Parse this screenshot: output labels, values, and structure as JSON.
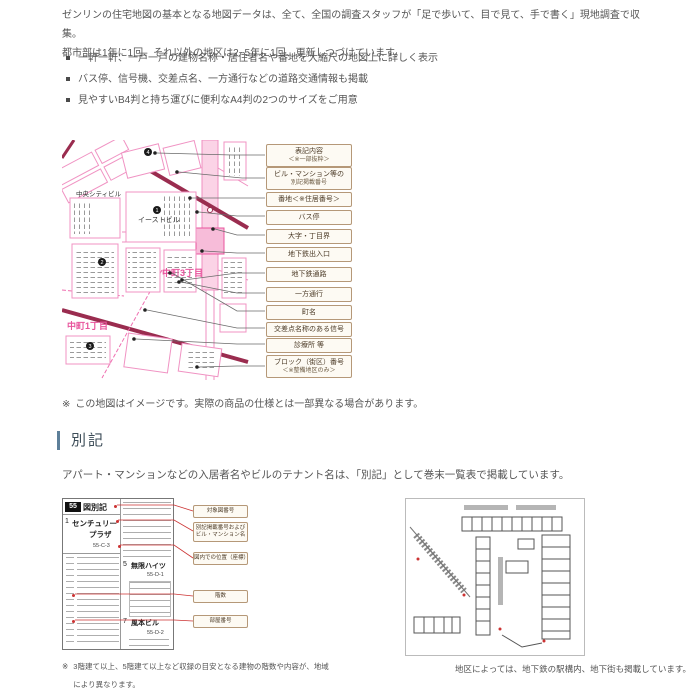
{
  "intro": {
    "line1": "ゼンリンの住宅地図の基本となる地図データは、全て、全国の調査スタッフが「足で歩いて、目で見て、手で書く」現地調査で収集。",
    "line2": "都市部は1年に1回、それ以外の地区は2~5年に1回、更新しつづけています。"
  },
  "features": {
    "item1": "一軒一軒、一戸一戸の建物名称・居住者名や番地を大縮尺の地図上に詳しく表示",
    "item2": "バス停、信号機、交差点名、一方通行などの道路交通情報も掲載",
    "item3": "見やすいB4判と持ち運びに便利なA4判の2つのサイズをご用意"
  },
  "map_figure": {
    "labels": {
      "building_a": "中央シティビル",
      "building_b": "イーストビル",
      "district_a": "中町3丁目",
      "district_b": "中町1丁目",
      "badge_1": "1",
      "badge_2": "2",
      "badge_3": "3",
      "badge_4": "4"
    },
    "callouts": [
      {
        "l1": "表記内容",
        "l2": "＜※一部抜粋＞"
      },
      {
        "l1": "ビル・マンション等の",
        "l2": "別記掲載番号"
      },
      {
        "l1": "番地＜※住居番号＞"
      },
      {
        "l1": "バス停"
      },
      {
        "l1": "大字・丁目界"
      },
      {
        "l1": "地下鉄出入口"
      },
      {
        "l1": "地下鉄通路"
      },
      {
        "l1": "一方通行"
      },
      {
        "l1": "町名"
      },
      {
        "l1": "交差点名称のある信号"
      },
      {
        "l1": "診療所 等"
      },
      {
        "l1": "ブロック（街区）番号",
        "l2": "＜※整備地区のみ＞"
      }
    ],
    "note_marker": "※",
    "note": "この地図はイメージです。実際の商品の仕様とは一部異なる場合があります。"
  },
  "bekki": {
    "heading": "別記",
    "description": "アパート・マンションなどの入居者名やビルのテナント名は、「別記」として巻末一覧表で掲載しています。",
    "sample": {
      "map_no": "55",
      "map_no_suffix": "図別記",
      "entry1_no": "1",
      "entry1_name1": "センチュリー",
      "entry1_name2": "プラザ",
      "entry1_pos": "55-C-3",
      "entry2_no": "5",
      "entry2_name": "無限ハイツ",
      "entry2_pos": "55-D-1",
      "entry3_no": "7",
      "entry3_name": "風本ビル",
      "entry3_pos": "55-D-2"
    },
    "callouts": [
      {
        "l1": "対象図番号"
      },
      {
        "l1": "別記掲載番号および",
        "l2": "ビル・マンション名"
      },
      {
        "l1": "図内での位置（座標）"
      },
      {
        "l1": "階数"
      },
      {
        "l1": "部屋番号"
      }
    ],
    "note_marker": "※",
    "note_l1": "3階建て以上、5階建て以上など収録の目安となる建物の階数や内容が、地域",
    "note_l2": "により異なります。"
  },
  "underground": {
    "caption": "地区によっては、地下鉄の駅構内、地下街も掲載しています。"
  },
  "colors": {
    "body_text": "#555555",
    "heading_bar": "#5d7f99",
    "map_pink": "#ef8fc0",
    "map_magenta": "#e8559d",
    "map_maroon": "#9a2c4f",
    "callout_bg": "#fdfaf3",
    "callout_border": "#b59878",
    "leader_red": "#cc3333"
  }
}
